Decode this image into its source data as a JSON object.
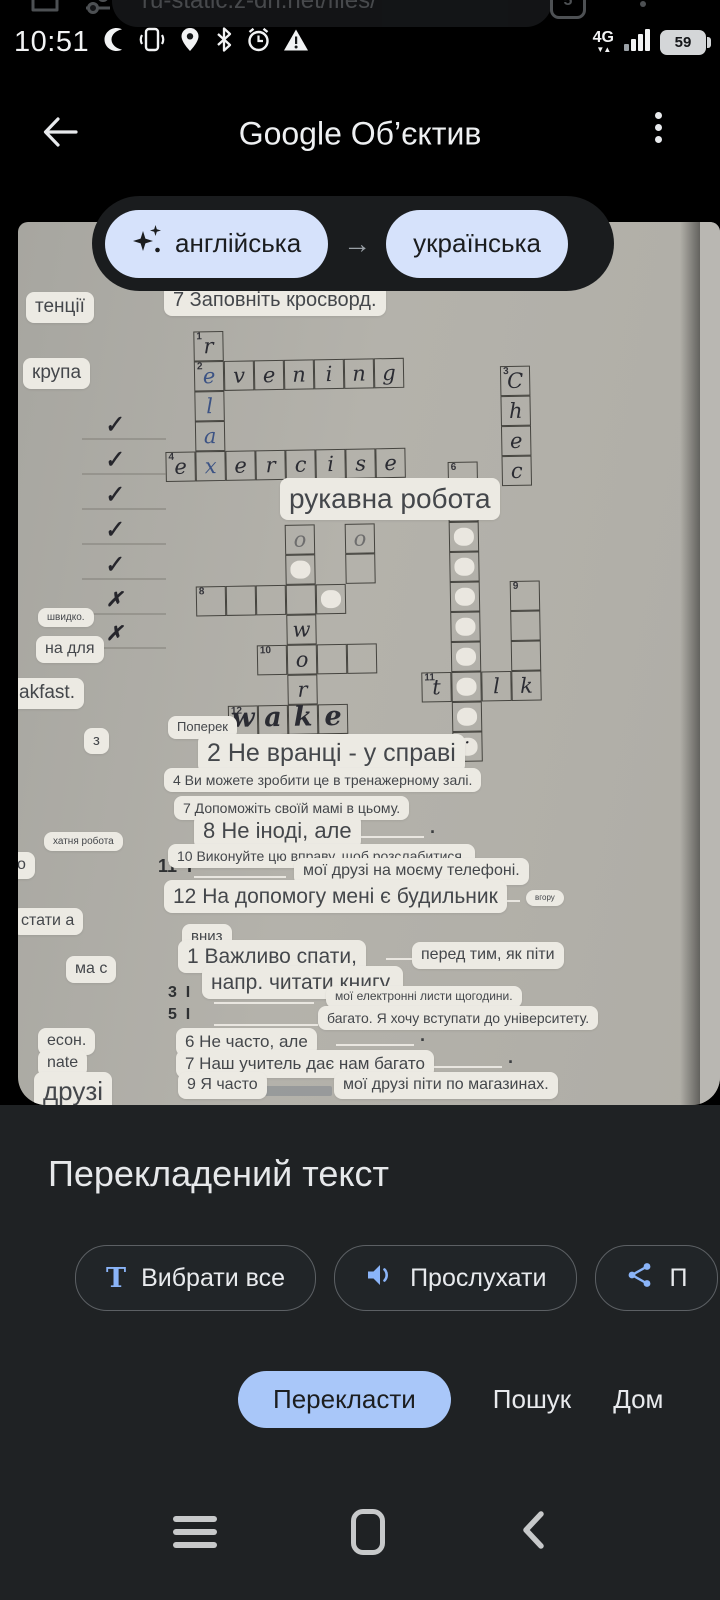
{
  "browser_bar": {
    "url": "ru-static.z-dn.net/files/",
    "tab_count": "5"
  },
  "status_bar": {
    "time": "10:51",
    "network": "4G",
    "net_arrows": "▼▲",
    "battery": "59"
  },
  "lens_header": {
    "title": "Google Об’єктив"
  },
  "language_bar": {
    "source": "англійська",
    "target": "українська",
    "arrow": "→"
  },
  "photo": {
    "chips": [
      {
        "t": "тенції",
        "x": 8,
        "y": 70,
        "fs": 19
      },
      {
        "t": "крупа",
        "x": 5,
        "y": 136,
        "fs": 19
      },
      {
        "t": "швидко.",
        "x": 20,
        "y": 386,
        "fs": 10
      },
      {
        "t": "на для",
        "x": 18,
        "y": 414,
        "fs": 16
      },
      {
        "t": "akfast.",
        "x": -8,
        "y": 456,
        "fs": 19
      },
      {
        "t": "з",
        "x": 66,
        "y": 506,
        "fs": 15
      },
      {
        "t": "хатня робота",
        "x": 26,
        "y": 610,
        "fs": 10
      },
      {
        "t": "о",
        "x": -10,
        "y": 630,
        "fs": 16
      },
      {
        "t": "стати а",
        "x": -6,
        "y": 686,
        "fs": 16
      },
      {
        "t": "ма с",
        "x": 48,
        "y": 734,
        "fs": 16
      },
      {
        "t": "есон.",
        "x": 20,
        "y": 806,
        "fs": 16
      },
      {
        "t": "nate",
        "x": 20,
        "y": 828,
        "fs": 16
      },
      {
        "t": "друзі",
        "x": 16,
        "y": 850,
        "fs": 26
      },
      {
        "t": "7 Заповніть кросворд.",
        "x": 146,
        "y": 62,
        "fs": 20
      },
      {
        "t": "рукавна робота",
        "x": 262,
        "y": 256,
        "fs": 28
      },
      {
        "t": "Поперек",
        "x": 150,
        "y": 494,
        "fs": 13
      },
      {
        "t": "2 Не вранці - у справі",
        "x": 180,
        "y": 512,
        "fs": 25
      },
      {
        "t": "4 Ви можете зробити це в тренажерному залі.",
        "x": 146,
        "y": 546,
        "fs": 14
      },
      {
        "t": "7 Допоможіть своїй мамі в цьому.",
        "x": 156,
        "y": 574,
        "fs": 14
      },
      {
        "t": "8 Не іноді, але",
        "x": 176,
        "y": 592,
        "fs": 22
      },
      {
        "t": "10 Виконуйте цю вправу, щоб розслабитися.",
        "x": 150,
        "y": 622,
        "fs": 14
      },
      {
        "t": "мої друзі на моєму телефоні.",
        "x": 276,
        "y": 636,
        "fs": 16
      },
      {
        "t": "12 На допомогу мені є будильник",
        "x": 146,
        "y": 658,
        "fs": 21
      },
      {
        "t": "вгору",
        "x": 508,
        "y": 668,
        "fs": 8
      },
      {
        "t": "вниз",
        "x": 164,
        "y": 702,
        "fs": 15
      },
      {
        "t": "1 Важливо спати,",
        "x": 160,
        "y": 718,
        "fs": 21
      },
      {
        "t": "перед тим, як піти",
        "x": 394,
        "y": 720,
        "fs": 16
      },
      {
        "t": "напр. читати книгу.",
        "x": 184,
        "y": 744,
        "fs": 21
      },
      {
        "t": "мої електронні листи щогодини.",
        "x": 308,
        "y": 764,
        "fs": 12
      },
      {
        "t": "багато. Я хочу вступати до університету.",
        "x": 300,
        "y": 784,
        "fs": 14
      },
      {
        "t": "6 Не часто, але",
        "x": 158,
        "y": 806,
        "fs": 17
      },
      {
        "t": "7 Наш учитель дає нам багато",
        "x": 158,
        "y": 828,
        "fs": 17
      },
      {
        "t": "9 Я часто",
        "x": 160,
        "y": 850,
        "fs": 16
      },
      {
        "t": "мої друзі піти по магазинах.",
        "x": 316,
        "y": 850,
        "fs": 16
      }
    ],
    "paper_texts": [
      {
        "t": "11  I",
        "x": 140,
        "y": 634,
        "fs": 18
      },
      {
        "t": "3  I",
        "x": 150,
        "y": 762,
        "fs": 16
      },
      {
        "t": "5  I",
        "x": 150,
        "y": 784,
        "fs": 16
      }
    ],
    "handwriting": [
      {
        "t": "✓",
        "x": 86,
        "y": 190,
        "fs": 22,
        "rot": -8
      },
      {
        "t": "✓",
        "x": 86,
        "y": 225,
        "fs": 22,
        "rot": -8
      },
      {
        "t": "✓",
        "x": 86,
        "y": 260,
        "fs": 22,
        "rot": -8
      },
      {
        "t": "✓",
        "x": 86,
        "y": 295,
        "fs": 22,
        "rot": -8
      },
      {
        "t": "✓",
        "x": 86,
        "y": 330,
        "fs": 22,
        "rot": -8
      },
      {
        "t": "✗",
        "x": 88,
        "y": 365,
        "fs": 20,
        "rot": 0
      },
      {
        "t": "✗",
        "x": 88,
        "y": 399,
        "fs": 20,
        "rot": 0
      },
      {
        "t": "ϑ",
        "x": 416,
        "y": 526,
        "fs": 16,
        "rot": -15
      },
      {
        "t": "– ·",
        "x": 436,
        "y": 514,
        "fs": 13,
        "rot": 0
      }
    ],
    "lines": [
      {
        "x": 64,
        "y": 216,
        "w": 84,
        "soft": true
      },
      {
        "x": 64,
        "y": 251,
        "w": 84,
        "soft": true
      },
      {
        "x": 64,
        "y": 286,
        "w": 84,
        "soft": true
      },
      {
        "x": 64,
        "y": 321,
        "w": 84,
        "soft": true
      },
      {
        "x": 64,
        "y": 356,
        "w": 84,
        "soft": true
      },
      {
        "x": 64,
        "y": 391,
        "w": 84,
        "soft": true
      },
      {
        "x": 64,
        "y": 425,
        "w": 84,
        "soft": true
      },
      {
        "x": 334,
        "y": 614,
        "w": 72,
        "dot": true
      },
      {
        "x": 176,
        "y": 654,
        "w": 92
      },
      {
        "x": 424,
        "y": 678,
        "w": 78
      },
      {
        "x": 368,
        "y": 736,
        "w": 52
      },
      {
        "x": 196,
        "y": 780,
        "w": 100
      },
      {
        "x": 196,
        "y": 802,
        "w": 104
      },
      {
        "x": 318,
        "y": 822,
        "w": 78,
        "dot": true
      },
      {
        "x": 404,
        "y": 844,
        "w": 80,
        "dot": true
      },
      {
        "x": 236,
        "y": 864,
        "w": 78,
        "bar": true
      }
    ],
    "grid": {
      "cell": 30,
      "cells": [
        {
          "x": 176,
          "y": 108,
          "n": "1",
          "l": "r"
        },
        {
          "x": 176,
          "y": 138,
          "n": "2",
          "l": "e",
          "b": 1
        },
        {
          "x": 176,
          "y": 168,
          "l": "l",
          "b": 1
        },
        {
          "x": 176,
          "y": 198,
          "l": "a",
          "b": 1
        },
        {
          "x": 206,
          "y": 138,
          "l": "v"
        },
        {
          "x": 236,
          "y": 138,
          "l": "e"
        },
        {
          "x": 266,
          "y": 138,
          "l": "n"
        },
        {
          "x": 296,
          "y": 138,
          "l": "i"
        },
        {
          "x": 326,
          "y": 138,
          "l": "n"
        },
        {
          "x": 356,
          "y": 138,
          "l": "g"
        },
        {
          "x": 146,
          "y": 228,
          "n": "4",
          "l": "e"
        },
        {
          "x": 176,
          "y": 228,
          "l": "x",
          "b": 1
        },
        {
          "x": 206,
          "y": 228,
          "l": "e"
        },
        {
          "x": 236,
          "y": 228,
          "l": "r"
        },
        {
          "x": 266,
          "y": 228,
          "l": "c"
        },
        {
          "x": 296,
          "y": 228,
          "l": "i"
        },
        {
          "x": 326,
          "y": 228,
          "l": "s"
        },
        {
          "x": 356,
          "y": 228,
          "l": "e"
        },
        {
          "x": 482,
          "y": 148,
          "n": "3",
          "l": "C"
        },
        {
          "x": 482,
          "y": 178,
          "l": "h"
        },
        {
          "x": 482,
          "y": 208,
          "l": "e"
        },
        {
          "x": 482,
          "y": 238,
          "l": "c"
        },
        {
          "x": 264,
          "y": 303,
          "l": "o",
          "f": 1
        },
        {
          "x": 324,
          "y": 303,
          "l": "o",
          "f": 1
        },
        {
          "x": 264,
          "y": 333,
          "wo": 1
        },
        {
          "x": 324,
          "y": 333
        },
        {
          "x": 174,
          "y": 363,
          "n": "8"
        },
        {
          "x": 204,
          "y": 363
        },
        {
          "x": 234,
          "y": 363
        },
        {
          "x": 264,
          "y": 363
        },
        {
          "x": 294,
          "y": 363,
          "wo": 1
        },
        {
          "x": 264,
          "y": 393,
          "l": "w"
        },
        {
          "x": 234,
          "y": 423,
          "n": "10"
        },
        {
          "x": 264,
          "y": 423,
          "l": "o"
        },
        {
          "x": 294,
          "y": 423
        },
        {
          "x": 324,
          "y": 423
        },
        {
          "x": 264,
          "y": 453,
          "l": "r"
        },
        {
          "x": 204,
          "y": 483,
          "n": "12",
          "l": "w",
          "big": 1
        },
        {
          "x": 234,
          "y": 483,
          "l": "a",
          "big": 1
        },
        {
          "x": 264,
          "y": 483,
          "l": "k",
          "big": 1
        },
        {
          "x": 294,
          "y": 483,
          "l": "e",
          "big": 1
        },
        {
          "x": 428,
          "y": 243,
          "n": "6"
        },
        {
          "x": 428,
          "y": 273,
          "wo": 1
        },
        {
          "x": 428,
          "y": 303,
          "wo": 1
        },
        {
          "x": 428,
          "y": 333,
          "wo": 1
        },
        {
          "x": 428,
          "y": 363,
          "wo": 1
        },
        {
          "x": 428,
          "y": 393,
          "wo": 1
        },
        {
          "x": 428,
          "y": 423,
          "wo": 1
        },
        {
          "x": 488,
          "y": 363,
          "n": "9"
        },
        {
          "x": 488,
          "y": 393
        },
        {
          "x": 488,
          "y": 423
        },
        {
          "x": 398,
          "y": 453,
          "n": "11",
          "l": "t"
        },
        {
          "x": 428,
          "y": 453,
          "wo": 1
        },
        {
          "x": 458,
          "y": 453,
          "l": "l"
        },
        {
          "x": 488,
          "y": 453,
          "l": "k"
        },
        {
          "x": 428,
          "y": 483,
          "wo": 1
        },
        {
          "x": 428,
          "y": 513,
          "wo": 1
        }
      ]
    }
  },
  "sheet": {
    "heading": "Перекладений текст",
    "actions": [
      {
        "glyph": "T",
        "label": "Вибрати все"
      },
      {
        "label": "Прослухати"
      },
      {
        "label": "П"
      }
    ],
    "tabs": [
      {
        "label": "Перекласти"
      },
      {
        "label": "Пошук"
      },
      {
        "label": "Дом"
      }
    ]
  }
}
